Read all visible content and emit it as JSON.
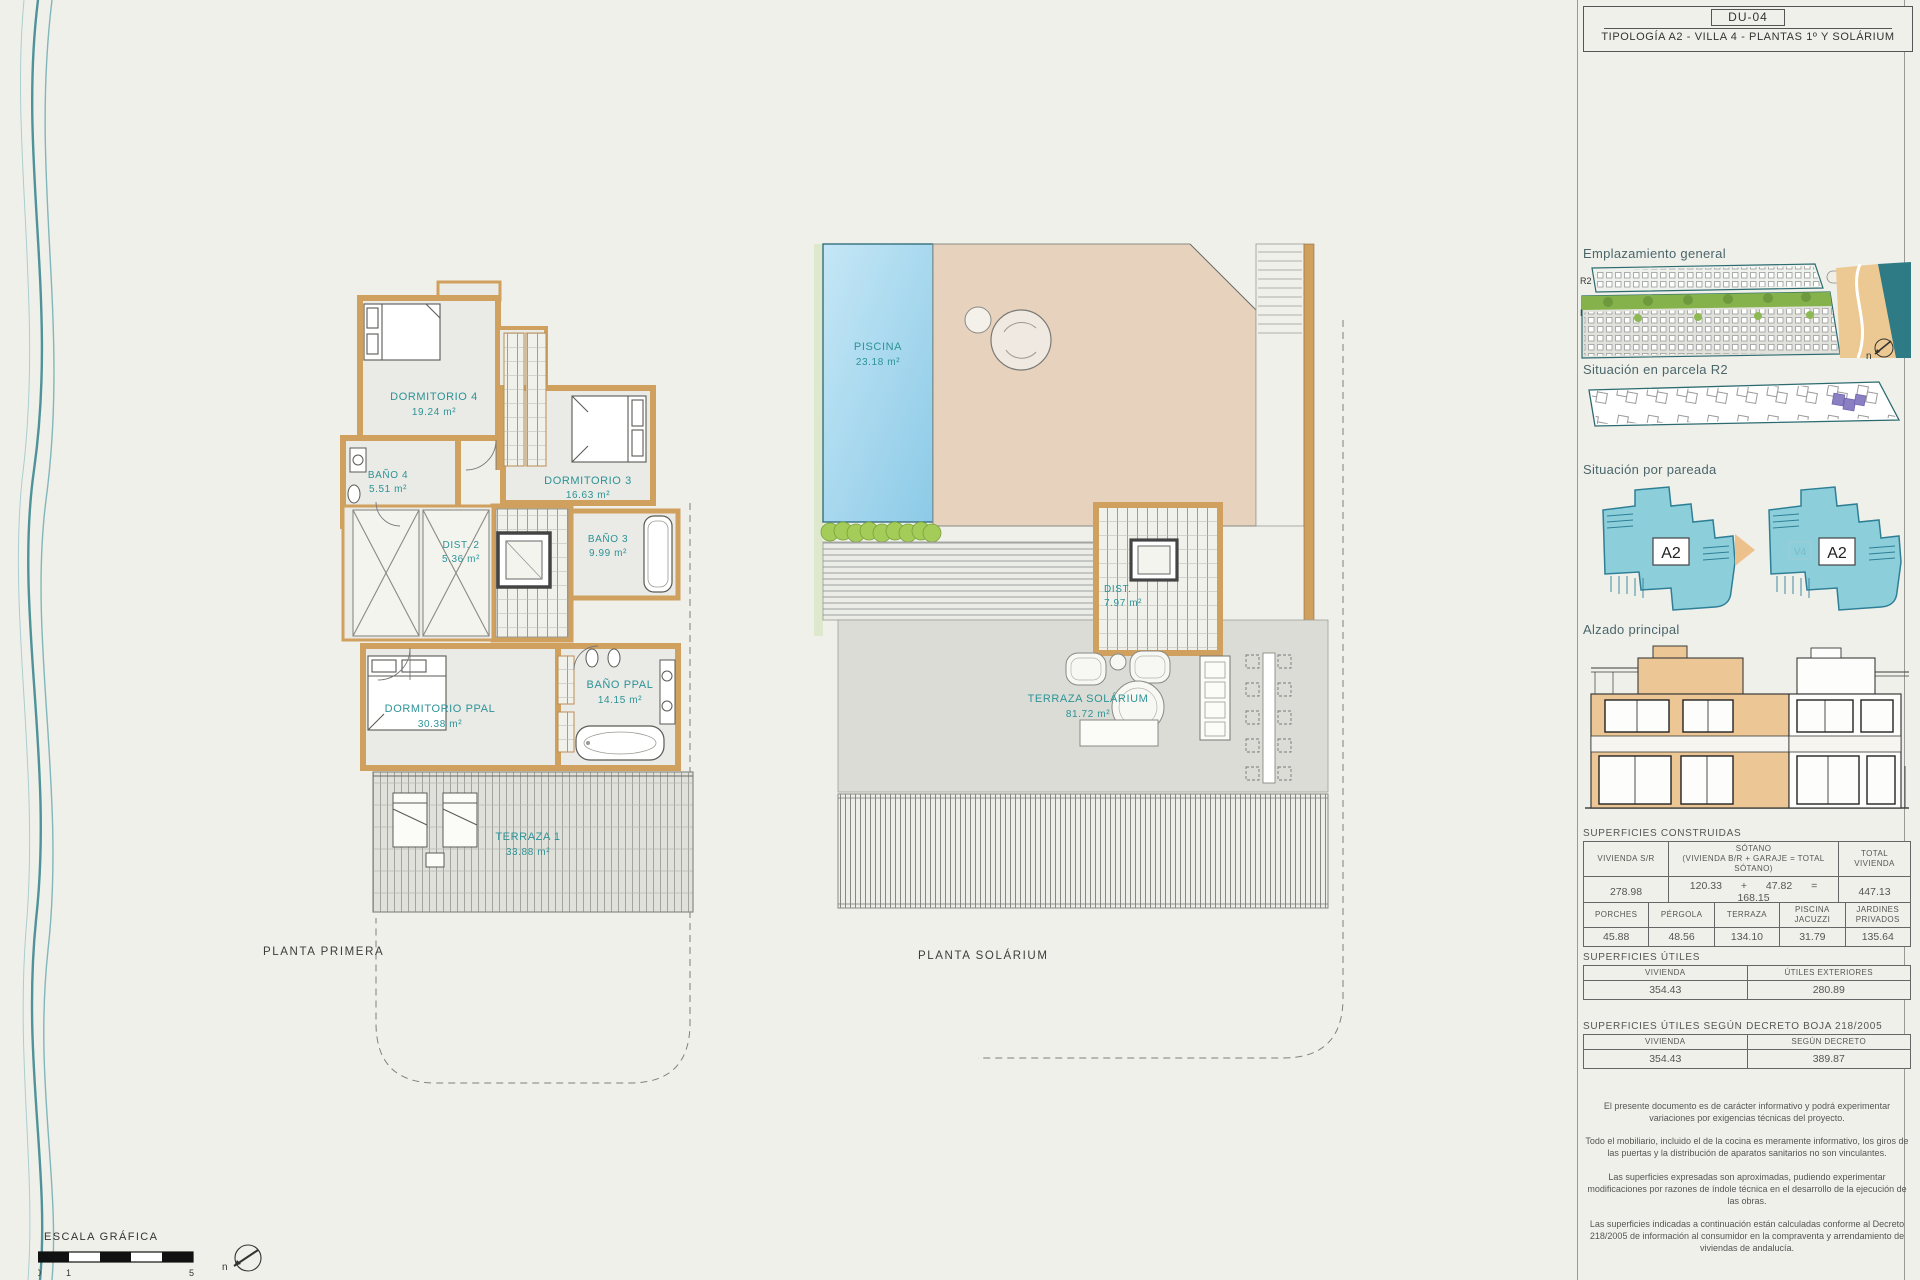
{
  "title_block": {
    "code": "DU-04",
    "title": "TIPOLOGÍA A2 - VILLA 4 - PLANTAS 1º Y SOLÁRIUM"
  },
  "sidebar": {
    "emplazamiento": {
      "heading": "Emplazamiento general",
      "r2": "R2",
      "r1": "R1",
      "north": "n"
    },
    "parcela": {
      "heading": "Situación en parcela R2"
    },
    "pareada": {
      "heading": "Situación por pareada",
      "left_label": "A2",
      "right_label": "A2",
      "right_ghost": "V4"
    },
    "alzado": {
      "heading": "Alzado principal"
    },
    "construidas": {
      "heading": "SUPERFICIES CONSTRUIDAS",
      "t1": {
        "h_vivienda": "VIVIENDA S/R",
        "h_sotano": "SÓTANO",
        "h_sotano_sub": "(VIVIENDA B/R + GARAJE = TOTAL SÓTANO)",
        "h_total": "TOTAL VIVIENDA",
        "vivienda": "278.98",
        "sot_a": "120.33",
        "plus": "+",
        "sot_b": "47.82",
        "eq": "=",
        "sot_total": "168.15",
        "total": "447.13"
      },
      "t2": {
        "headers": [
          "PORCHES",
          "PÉRGOLA",
          "TERRAZA",
          "PISCINA JACUZZI",
          "JARDINES PRIVADOS"
        ],
        "values": [
          "45.88",
          "48.56",
          "134.10",
          "31.79",
          "135.64"
        ]
      }
    },
    "utiles": {
      "heading": "SUPERFICIES ÚTILES",
      "headers": [
        "VIVIENDA",
        "ÚTILES EXTERIORES"
      ],
      "values": [
        "354.43",
        "280.89"
      ]
    },
    "decreto": {
      "heading": "SUPERFICIES ÚTILES SEGÚN DECRETO BOJA 218/2005",
      "headers": [
        "VIVIENDA",
        "SEGÚN DECRETO"
      ],
      "values": [
        "354.43",
        "389.87"
      ]
    },
    "disclaimers": [
      "El presente documento es de carácter informativo y podrá experimentar variaciones por exigencias técnicas del proyecto.",
      "Todo el mobiliario, incluido el de la cocina es meramente informativo, los giros de las puertas y la distribución de aparatos sanitarios no son vinculantes.",
      "Las superficies expresadas son aproximadas, pudiendo experimentar modificaciones por razones de índole técnica en el desarrollo de la ejecución de las obras.",
      "Las superficies indicadas a continuación están calculadas conforme al Decreto 218/2005 de información al consumidor en la compraventa y arrendamiento de viviendas de andalucía."
    ]
  },
  "plans": {
    "primera": {
      "title": "PLANTA PRIMERA",
      "rooms": {
        "dorm4": {
          "name": "DORMITORIO 4",
          "area": "19.24 m²"
        },
        "bano4": {
          "name": "BAÑO 4",
          "area": "5.51 m²"
        },
        "dorm3": {
          "name": "DORMITORIO 3",
          "area": "16.63 m²"
        },
        "bano3": {
          "name": "BAÑO 3",
          "area": "9.99 m²"
        },
        "dist2": {
          "name": "DIST. 2",
          "area": "5.36 m²"
        },
        "dormppal": {
          "name": "DORMITORIO PPAL",
          "area": "30.38 m²"
        },
        "banoppal": {
          "name": "BAÑO PPAL",
          "area": "14.15 m²"
        },
        "terraza1": {
          "name": "TERRAZA 1",
          "area": "33.88 m²"
        }
      }
    },
    "solarium": {
      "title": "PLANTA SOLÁRIUM",
      "rooms": {
        "piscina": {
          "name": "PISCINA",
          "area": "23.18 m²"
        },
        "dist3": {
          "name": "DIST.",
          "area": "7.97 m²"
        },
        "terraza": {
          "name": "TERRAZA SOLÁRIUM",
          "area": "81.72 m²"
        }
      }
    }
  },
  "scale": {
    "label": "ESCALA GRÁFICA",
    "t0": "0",
    "t1": "1",
    "t5": "5",
    "north": "n"
  }
}
